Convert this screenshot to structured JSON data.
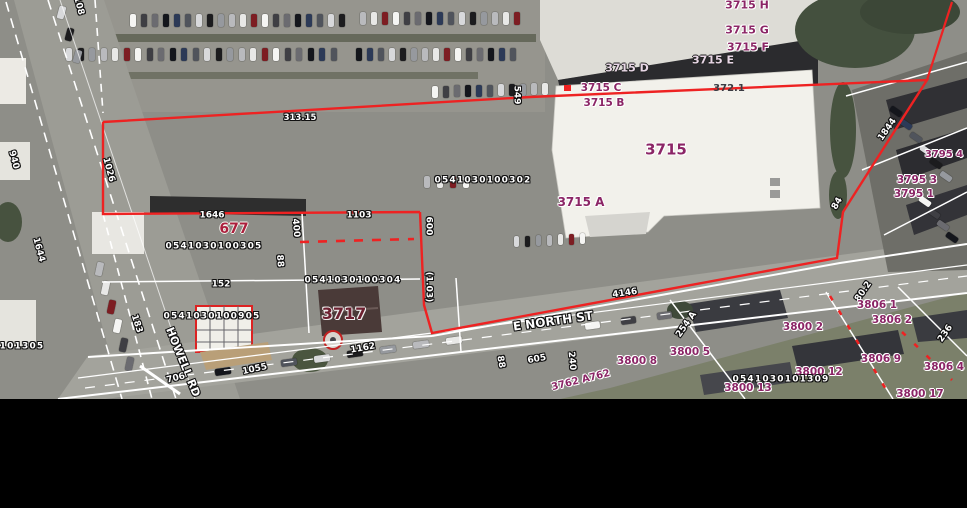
{
  "colors": {
    "boundary_red": "#ee2222",
    "parcel_label_purple": "#8b2566",
    "parcel_label_red": "#ab1f3c",
    "parcel_label_dark_red": "#6d2030",
    "dimension_label_white": "#ffffff",
    "asphalt_gray": "#8e8e88",
    "building_white": "#f2f1eb",
    "roof_dark": "#2b2b2e"
  },
  "streets": {
    "e_north": "E NORTH ST",
    "howell": "HOWELL RD"
  },
  "parcel_ids": [
    "0541030100302",
    "0541030100305",
    "0541030100304",
    "0541030100905",
    "0541030101309"
  ],
  "labels": [
    {
      "text": "3715 H",
      "x": 747,
      "y": 5,
      "cls": "purple",
      "size": 11,
      "name": "parcel-3715-h"
    },
    {
      "text": "3715 G",
      "x": 747,
      "y": 30,
      "cls": "purple",
      "size": 11,
      "name": "parcel-3715-g"
    },
    {
      "text": "3715 F",
      "x": 748,
      "y": 47,
      "cls": "purple",
      "size": 11,
      "name": "parcel-3715-f"
    },
    {
      "text": "3715 E",
      "x": 713,
      "y": 60,
      "cls": "lav",
      "size": 11,
      "name": "parcel-3715-e"
    },
    {
      "text": "3715 D",
      "x": 627,
      "y": 68,
      "cls": "lav",
      "size": 11,
      "name": "parcel-3715-d"
    },
    {
      "text": "3715 C",
      "x": 601,
      "y": 88,
      "cls": "purple",
      "size": 10.5,
      "name": "parcel-3715-c"
    },
    {
      "text": "372.1",
      "x": 729,
      "y": 89,
      "cls": "dark",
      "size": 10,
      "name": "dim-372-1"
    },
    {
      "text": "3715 B",
      "x": 604,
      "y": 103,
      "cls": "purple",
      "size": 10.5,
      "name": "parcel-3715-b"
    },
    {
      "text": "3715",
      "x": 666,
      "y": 150,
      "cls": "purple",
      "size": 15,
      "name": "parcel-3715"
    },
    {
      "text": "3715 A",
      "x": 581,
      "y": 202,
      "cls": "purple",
      "size": 12,
      "name": "parcel-3715-a"
    },
    {
      "text": "0541030100302",
      "x": 483,
      "y": 181,
      "cls": "white id",
      "size": 9,
      "name": "parcel-id-302"
    },
    {
      "text": "677",
      "x": 234,
      "y": 229,
      "cls": "red",
      "size": 14,
      "name": "parcel-677"
    },
    {
      "text": "0541030100305",
      "x": 214,
      "y": 247,
      "cls": "white id",
      "size": 9,
      "name": "parcel-id-305"
    },
    {
      "text": "1646",
      "x": 212,
      "y": 216,
      "cls": "white",
      "size": 9,
      "name": "dim-1646"
    },
    {
      "text": "1103",
      "x": 359,
      "y": 216,
      "cls": "white",
      "size": 9,
      "name": "dim-1103"
    },
    {
      "text": "152",
      "x": 221,
      "y": 285,
      "cls": "white",
      "size": 9,
      "name": "dim-152"
    },
    {
      "text": "0541030100304",
      "x": 353,
      "y": 281,
      "cls": "white id",
      "size": 9,
      "name": "parcel-id-304"
    },
    {
      "text": "0541030100905",
      "x": 212,
      "y": 317,
      "cls": "white id",
      "size": 9,
      "name": "parcel-id-905"
    },
    {
      "text": "3717",
      "x": 344,
      "y": 314,
      "cls": "darkred",
      "size": 16,
      "name": "parcel-3717"
    },
    {
      "text": "E NORTH ST",
      "x": 553,
      "y": 321,
      "rot": -8,
      "cls": "white",
      "size": 12,
      "name": "street-e-north-st"
    },
    {
      "text": "HOWELL RD",
      "x": 183,
      "y": 362,
      "rot": 68,
      "cls": "white",
      "size": 11,
      "name": "street-howell-rd"
    },
    {
      "text": "1055",
      "x": 255,
      "y": 370,
      "rot": -12,
      "cls": "white",
      "size": 9,
      "name": "dim-1055"
    },
    {
      "text": "706",
      "x": 176,
      "y": 379,
      "rot": -14,
      "cls": "white",
      "size": 9,
      "name": "dim-706"
    },
    {
      "text": "1162",
      "x": 363,
      "y": 349,
      "rot": -10,
      "cls": "white",
      "size": 9,
      "name": "dim-1162"
    },
    {
      "text": "4146",
      "x": 625,
      "y": 294,
      "rot": -8,
      "cls": "white",
      "size": 9,
      "name": "dim-4146"
    },
    {
      "text": "605",
      "x": 537,
      "y": 360,
      "rot": -10,
      "cls": "white",
      "size": 9,
      "name": "dim-605"
    },
    {
      "text": "549",
      "x": 516,
      "y": 95,
      "rot": 90,
      "cls": "white",
      "size": 9,
      "name": "dim-549"
    },
    {
      "text": "600",
      "x": 428,
      "y": 226,
      "rot": 90,
      "cls": "white",
      "size": 9,
      "name": "dim-600"
    },
    {
      "text": "400",
      "x": 295,
      "y": 228,
      "rot": 85,
      "cls": "white",
      "size": 9,
      "name": "dim-400"
    },
    {
      "text": "88",
      "x": 279,
      "y": 261,
      "rot": 85,
      "cls": "white",
      "size": 9,
      "name": "dim-88-left"
    },
    {
      "text": "(1.03)",
      "x": 428,
      "y": 287,
      "rot": 90,
      "cls": "white",
      "size": 9,
      "name": "dim-1-03-acres"
    },
    {
      "text": "940",
      "x": 13,
      "y": 160,
      "rot": 75,
      "cls": "white",
      "size": 9,
      "name": "dim-940"
    },
    {
      "text": "1026",
      "x": 108,
      "y": 170,
      "rot": 75,
      "cls": "white",
      "size": 9,
      "name": "dim-1026"
    },
    {
      "text": "1644",
      "x": 38,
      "y": 250,
      "rot": 75,
      "cls": "white",
      "size": 9,
      "name": "dim-1644"
    },
    {
      "text": "183",
      "x": 136,
      "y": 324,
      "rot": 72,
      "cls": "white",
      "size": 9,
      "name": "dim-183"
    },
    {
      "text": "108",
      "x": 78,
      "y": 6,
      "rot": 75,
      "cls": "white",
      "size": 9,
      "name": "dim-108"
    },
    {
      "text": "101305",
      "x": 22,
      "y": 347,
      "cls": "white id",
      "size": 9,
      "name": "parcel-id-101305-partial"
    },
    {
      "text": "313.15",
      "x": 300,
      "y": 118,
      "cls": "white",
      "size": 8.5,
      "name": "dim-313-15"
    },
    {
      "text": "88",
      "x": 500,
      "y": 362,
      "rot": 80,
      "cls": "white",
      "size": 9,
      "name": "dim-88-road"
    },
    {
      "text": "240",
      "x": 571,
      "y": 361,
      "rot": 85,
      "cls": "white",
      "size": 9,
      "name": "dim-240"
    },
    {
      "text": "1844",
      "x": 888,
      "y": 130,
      "rot": -55,
      "cls": "white",
      "size": 9,
      "name": "dim-1844"
    },
    {
      "text": "84",
      "x": 838,
      "y": 204,
      "rot": -60,
      "cls": "white",
      "size": 9,
      "name": "dim-84"
    },
    {
      "text": "236",
      "x": 946,
      "y": 334,
      "rot": -55,
      "cls": "white",
      "size": 9,
      "name": "dim-236"
    },
    {
      "text": "254 A",
      "x": 687,
      "y": 325,
      "rot": -55,
      "cls": "white",
      "size": 9,
      "name": "dim-254-a"
    },
    {
      "text": "80.2",
      "x": 864,
      "y": 292,
      "rot": -55,
      "cls": "white",
      "size": 9,
      "name": "dim-80-2"
    },
    {
      "text": "3795 4",
      "x": 944,
      "y": 155,
      "cls": "purple",
      "size": 10,
      "name": "parcel-3795-4"
    },
    {
      "text": "3795 3",
      "x": 917,
      "y": 180,
      "cls": "purple",
      "size": 10.5,
      "name": "parcel-3795-3"
    },
    {
      "text": "3795 1",
      "x": 914,
      "y": 194,
      "cls": "purple",
      "size": 10.5,
      "name": "parcel-3795-1"
    },
    {
      "text": "3806 1",
      "x": 877,
      "y": 305,
      "cls": "purple",
      "size": 10.5,
      "name": "parcel-3806-1"
    },
    {
      "text": "3806 2",
      "x": 892,
      "y": 320,
      "cls": "purple",
      "size": 10.5,
      "name": "parcel-3806-2"
    },
    {
      "text": "3800 2",
      "x": 803,
      "y": 327,
      "cls": "purple",
      "size": 10.5,
      "name": "parcel-3800-2"
    },
    {
      "text": "3800 5",
      "x": 690,
      "y": 352,
      "cls": "purple",
      "size": 10.5,
      "name": "parcel-3800-5"
    },
    {
      "text": "3800 8",
      "x": 637,
      "y": 361,
      "cls": "purple",
      "size": 10.5,
      "name": "parcel-3800-8"
    },
    {
      "text": "3806 9",
      "x": 881,
      "y": 359,
      "cls": "purple",
      "size": 10.5,
      "name": "parcel-3806-9"
    },
    {
      "text": "3806 4",
      "x": 944,
      "y": 367,
      "cls": "purple",
      "size": 10.5,
      "name": "parcel-3806-4"
    },
    {
      "text": "3800 12",
      "x": 819,
      "y": 372,
      "cls": "purple",
      "size": 10.5,
      "name": "parcel-3800-12"
    },
    {
      "text": "0541030101309",
      "x": 781,
      "y": 380,
      "cls": "white id",
      "size": 9,
      "name": "parcel-id-1309"
    },
    {
      "text": "3800 13",
      "x": 748,
      "y": 388,
      "cls": "purple",
      "size": 10.5,
      "name": "parcel-3800-13"
    },
    {
      "text": "3800 17",
      "x": 920,
      "y": 394,
      "cls": "purple",
      "size": 10.5,
      "name": "parcel-3800-17"
    },
    {
      "text": "3762 A762",
      "x": 581,
      "y": 381,
      "rot": -14,
      "cls": "purple",
      "size": 10,
      "name": "parcel-3762-a"
    }
  ],
  "car_colors": [
    "#f5f5f3",
    "#1c1c1e",
    "#6b6b70",
    "#b9babd",
    "#2c3a57",
    "#7d1d22",
    "#d8d9db",
    "#3f3f44",
    "#96999e",
    "#14161c",
    "#e8e8e6",
    "#50545c"
  ],
  "car_rows": [
    {
      "x": 130,
      "y": 14,
      "count": 20,
      "dx": 11,
      "dy": 0,
      "w": 6,
      "h": 13,
      "rot": 0
    },
    {
      "x": 360,
      "y": 12,
      "count": 15,
      "dx": 11,
      "dy": 0,
      "w": 6,
      "h": 13,
      "rot": 0
    },
    {
      "x": 66,
      "y": 48,
      "count": 24,
      "dx": 11.5,
      "dy": 0,
      "w": 6,
      "h": 13,
      "rot": 0
    },
    {
      "x": 356,
      "y": 48,
      "count": 15,
      "dx": 11,
      "dy": 0,
      "w": 6,
      "h": 13,
      "rot": 0
    },
    {
      "x": 432,
      "y": 86,
      "count": 11,
      "dx": 11,
      "dy": -0.3,
      "w": 6,
      "h": 12,
      "rot": 0
    },
    {
      "x": 424,
      "y": 176,
      "count": 4,
      "dx": 13,
      "dy": 0,
      "w": 6,
      "h": 12,
      "rot": 0
    },
    {
      "x": 514,
      "y": 236,
      "count": 7,
      "dx": 11,
      "dy": -0.5,
      "w": 5,
      "h": 11,
      "rot": 0
    },
    {
      "x": 215,
      "y": 368,
      "count": 8,
      "dx": 33,
      "dy": -4.5,
      "w": 16,
      "h": 7,
      "rot": -8
    },
    {
      "x": 585,
      "y": 322,
      "count": 3,
      "dx": 36,
      "dy": -5,
      "w": 15,
      "h": 7,
      "rot": -8
    },
    {
      "x": 96,
      "y": 262,
      "count": 6,
      "dx": 6,
      "dy": 19,
      "w": 7,
      "h": 14,
      "rot": 12
    },
    {
      "x": 58,
      "y": 6,
      "count": 3,
      "dx": 8,
      "dy": 22,
      "w": 7,
      "h": 13,
      "rot": 15
    },
    {
      "x": 893,
      "y": 105,
      "count": 6,
      "dx": 10,
      "dy": 13,
      "w": 6,
      "h": 13,
      "rot": -55
    },
    {
      "x": 922,
      "y": 195,
      "count": 4,
      "dx": 9,
      "dy": 12,
      "w": 6,
      "h": 13,
      "rot": -55
    }
  ]
}
